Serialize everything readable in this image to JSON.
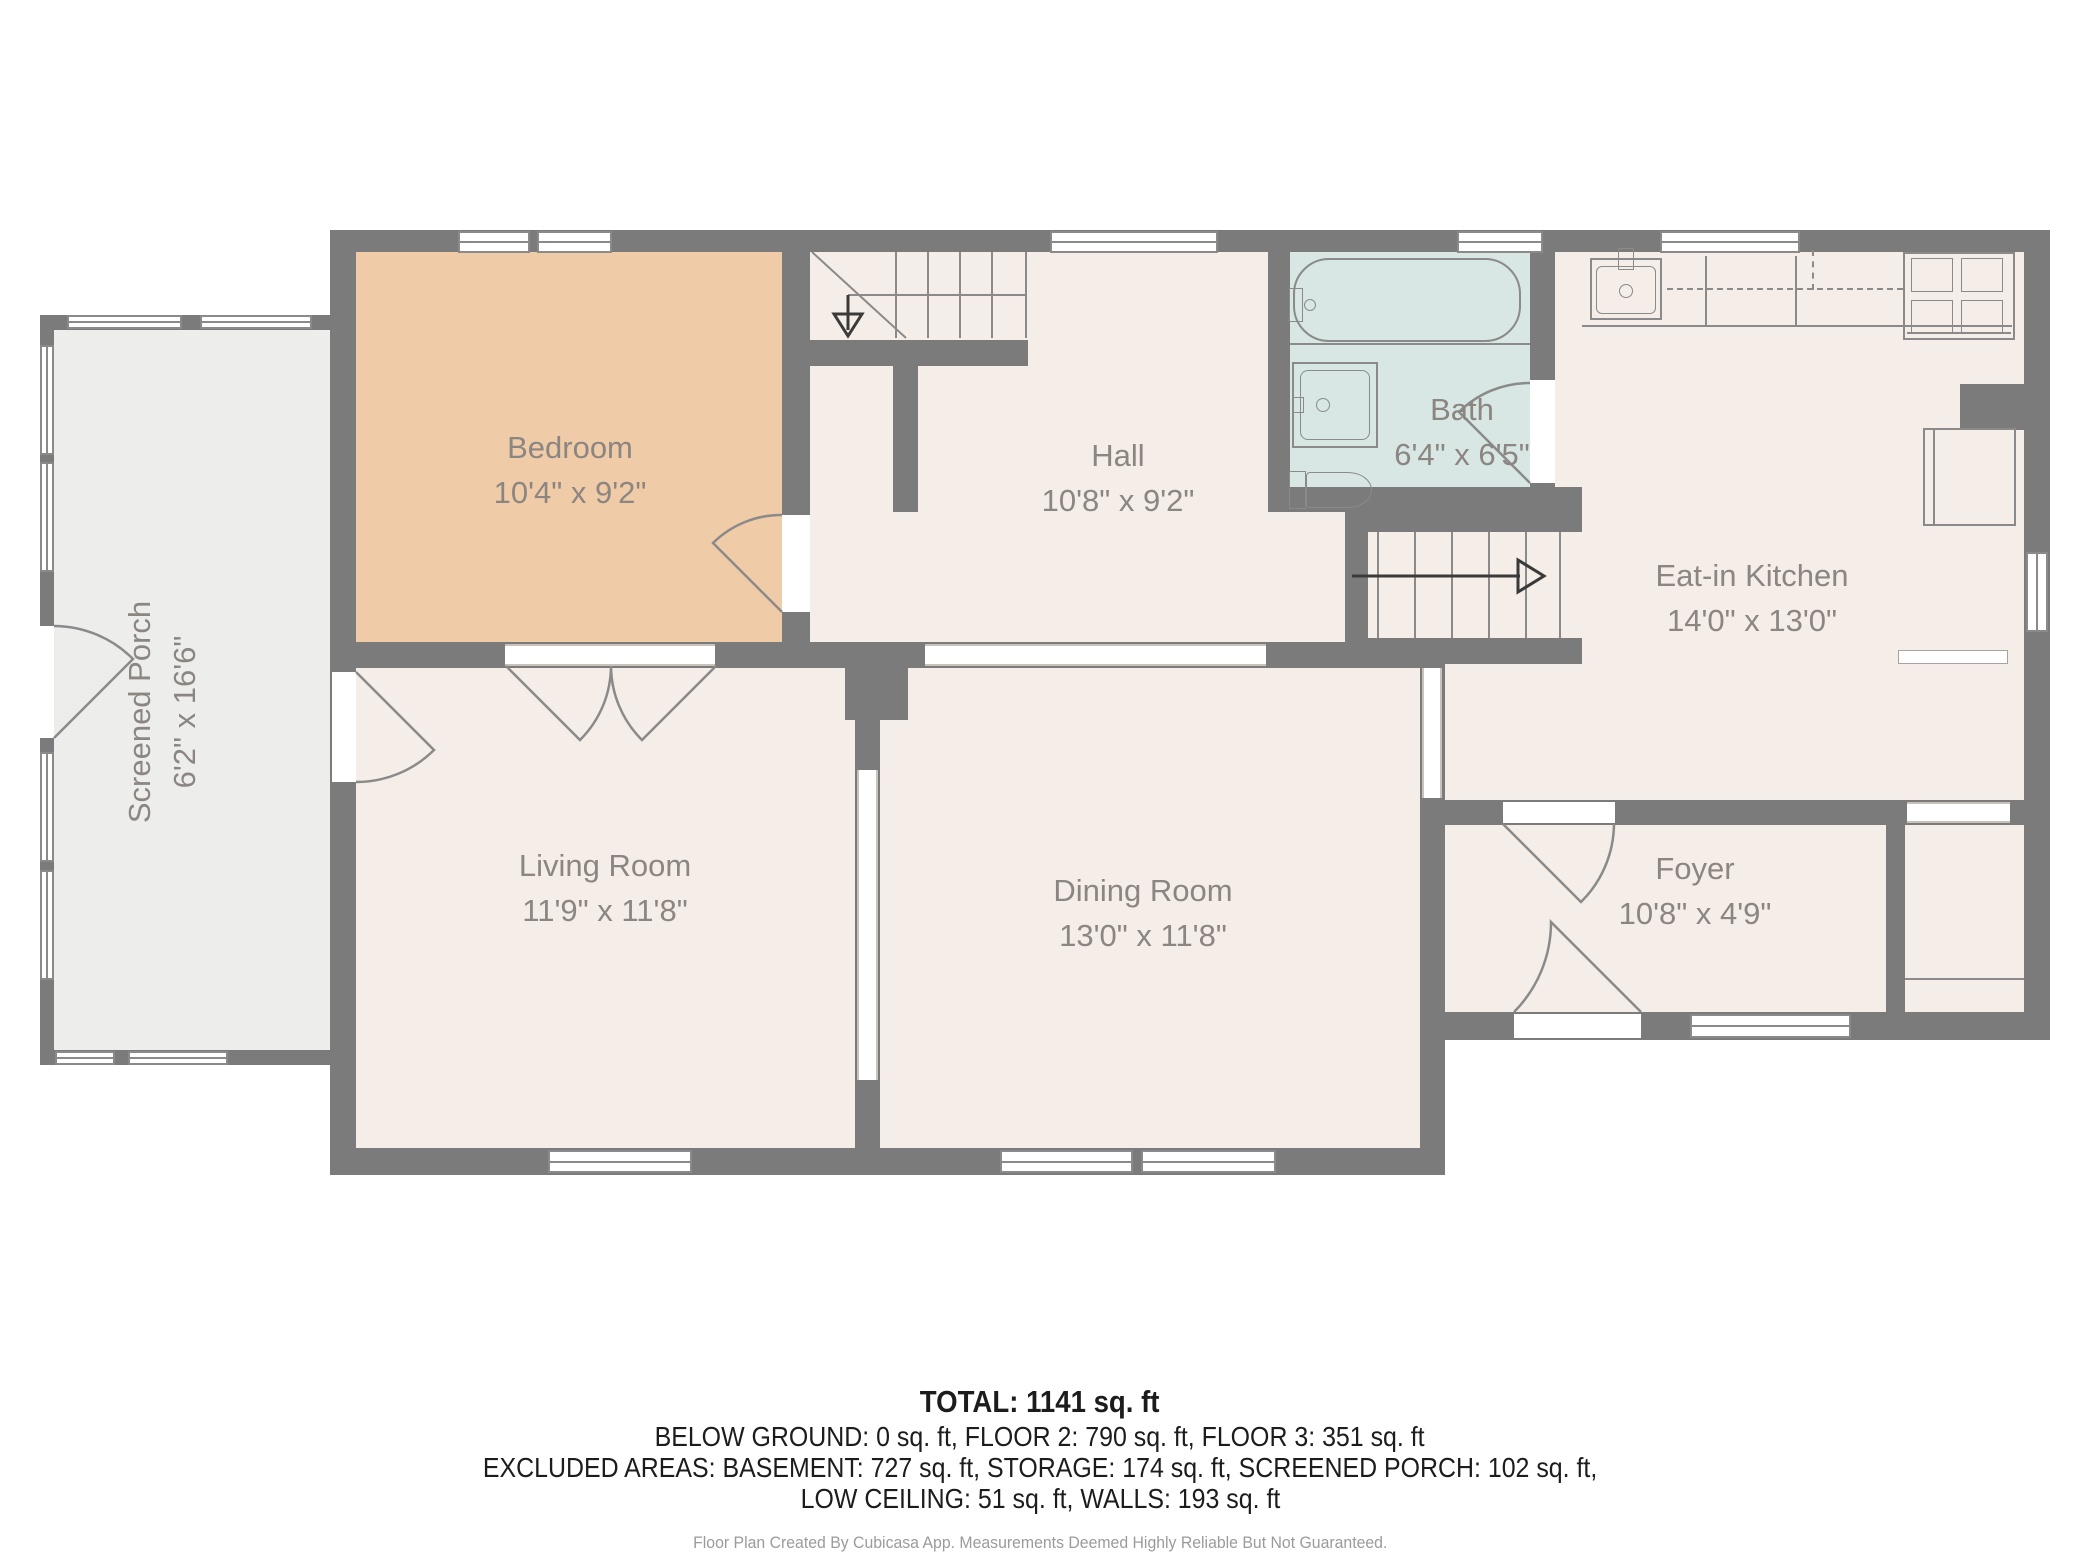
{
  "plan": {
    "rooms": [
      {
        "id": "bedroom",
        "name": "Bedroom",
        "dims": "10'4\" x 9'2\""
      },
      {
        "id": "hall",
        "name": "Hall",
        "dims": "10'8\" x 9'2\""
      },
      {
        "id": "bath",
        "name": "Bath",
        "dims": "6'4\" x 6'5\""
      },
      {
        "id": "eat-in-kitchen",
        "name": "Eat-in Kitchen",
        "dims": "14'0\" x 13'0\""
      },
      {
        "id": "screened-porch",
        "name": "Screened Porch",
        "dims": "6'2\" x 16'6\""
      },
      {
        "id": "living-room",
        "name": "Living Room",
        "dims": "11'9\" x 11'8\""
      },
      {
        "id": "dining-room",
        "name": "Dining Room",
        "dims": "13'0\" x 11'8\""
      },
      {
        "id": "foyer",
        "name": "Foyer",
        "dims": "10'8\" x 4'9\""
      }
    ]
  },
  "summary": {
    "total": "TOTAL: 1141 sq. ft",
    "floors": "BELOW GROUND: 0 sq. ft, FLOOR 2: 790 sq. ft, FLOOR 3: 351 sq. ft",
    "excluded": "EXCLUDED AREAS: BASEMENT: 727 sq. ft, STORAGE: 174 sq. ft, SCREENED PORCH: 102 sq. ft,",
    "excluded2": "LOW CEILING: 51 sq. ft, WALLS: 193 sq. ft"
  },
  "footer": "Floor Plan Created By Cubicasa App. Measurements Deemed Highly Reliable But Not Guaranteed.",
  "colors": {
    "wall": "#7B7B7B",
    "floor": "#F5EDE7",
    "bedroom_fill": "#F0CBA7",
    "bath_fill": "#D8E7E4",
    "porch_fill": "#EDEDEC",
    "label_text": "#8B8682"
  }
}
